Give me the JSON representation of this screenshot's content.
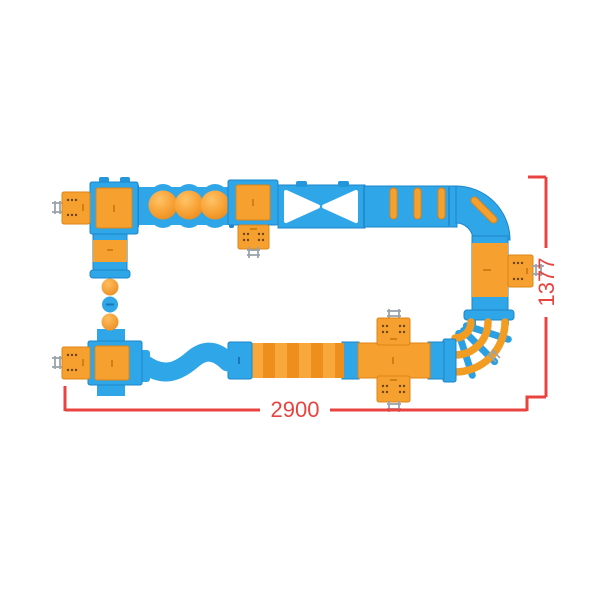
{
  "figure": {
    "type": "product-top-view-diagram",
    "subject": "modular kids play crawl-tunnel layout, top view, with dimension callouts"
  },
  "dimensions": {
    "width_label": "2900",
    "height_label": "1377"
  },
  "colors": {
    "tunnel_blue": "#2fa6e8",
    "tunnel_blue_edge": "#1e86c8",
    "module_orange": "#f6a030",
    "module_orange_edge": "#dd8414",
    "stripe_orange_dark": "#ee8e1c",
    "vent_dot_brown": "#6e4410",
    "ladder_grey": "#9aa4ac",
    "dimension_red": "#e8433f",
    "background": "#ffffff"
  },
  "parts": [
    "end-cap-top-left",
    "crawl-box-top-left",
    "vertical-link",
    "ball-steps",
    "dome-tunnel",
    "crawl-box-top-mid",
    "entry-box",
    "x-crossing-tunnel",
    "ribbed-tunnel",
    "corner-elbow-top-right",
    "right-pipe",
    "side-entry-box",
    "rope-curve-bridge",
    "cross-module-bottom-right",
    "striped-tunnel",
    "connector-block",
    "wavy-tunnel",
    "crawl-box-bottom-left",
    "end-cap-bottom-left"
  ]
}
